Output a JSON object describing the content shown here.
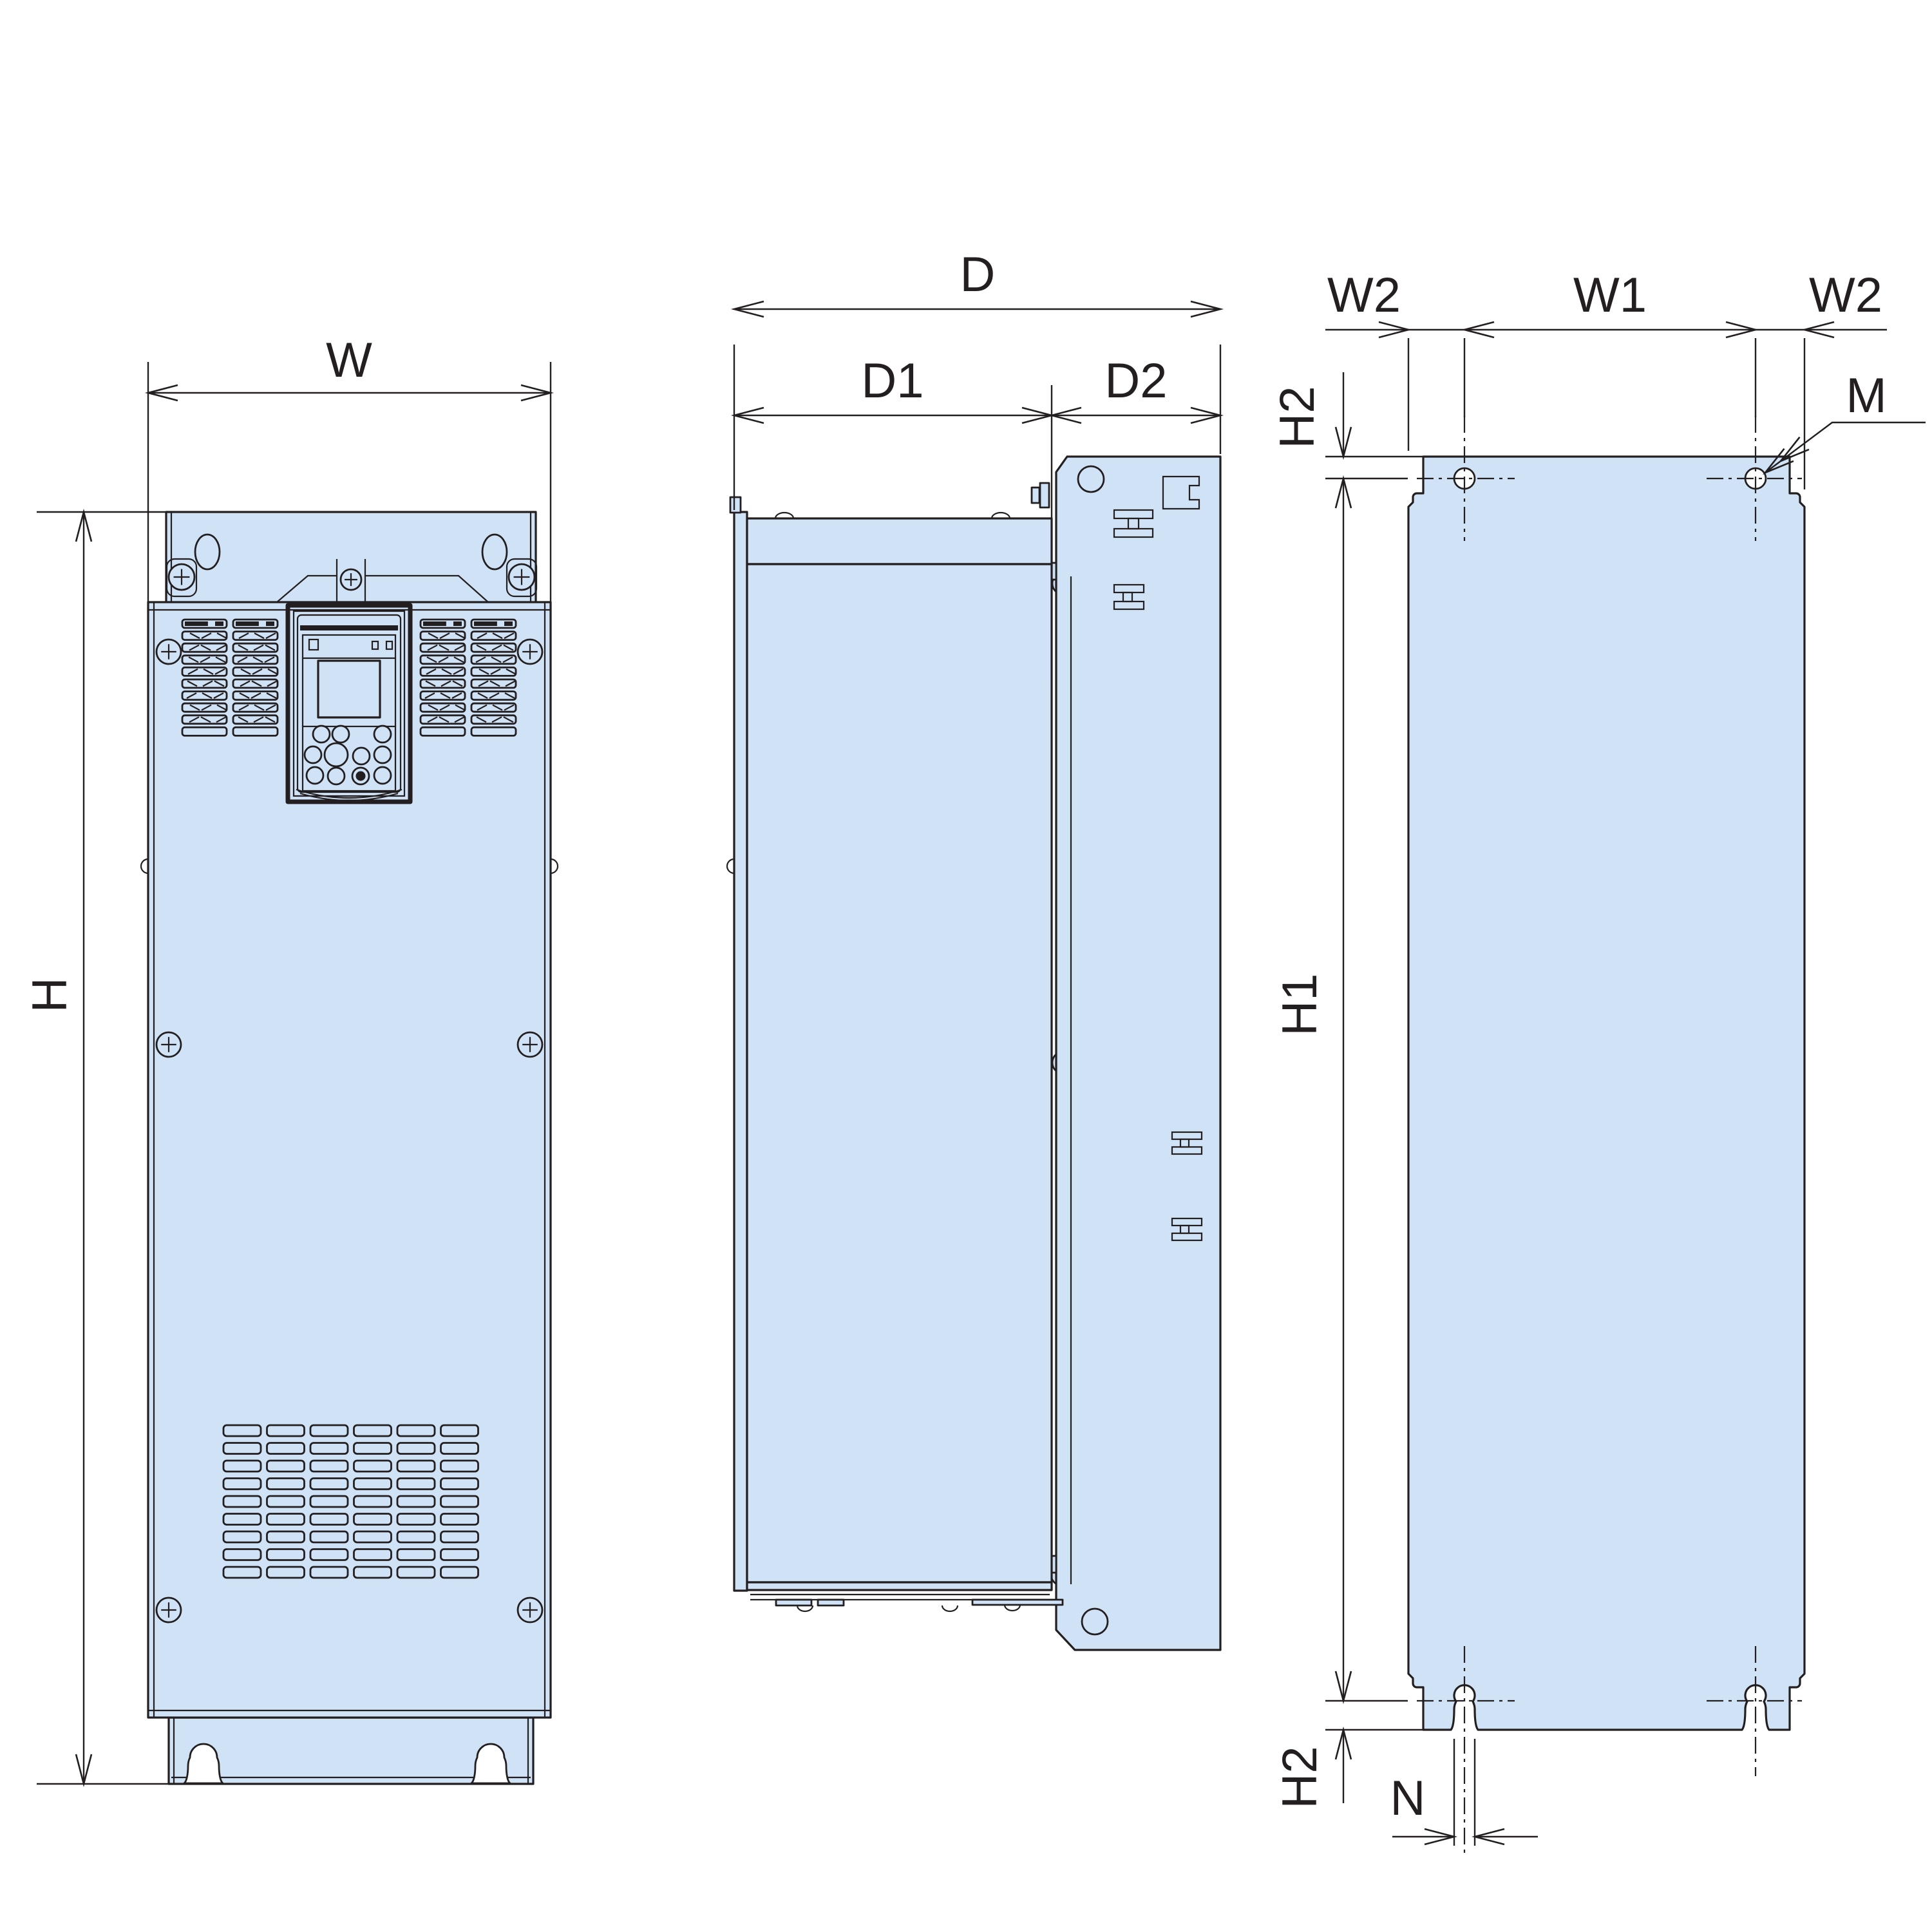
{
  "colors": {
    "background": "#ffffff",
    "panel_fill": "#cfe2f6",
    "line": "#231f20"
  },
  "views": {
    "front": {
      "dims": {
        "width": "W",
        "height": "H"
      },
      "vents": {
        "upper_blocks": 4,
        "upper_rows": 10,
        "lower_cols": 6,
        "lower_rows": 9
      }
    },
    "side": {
      "dims": {
        "depth": "D",
        "depth_body": "D1",
        "depth_plate": "D2"
      }
    },
    "rear": {
      "dims": {
        "edge_to_hole_left": "W2",
        "hole_spacing": "W1",
        "edge_to_hole_right": "W2",
        "top_edge_to_hole": "H2",
        "hole_to_slot_height": "H1",
        "slot_to_bottom_edge": "H2",
        "slot_width": "N",
        "mounting_hole": "M"
      }
    }
  }
}
